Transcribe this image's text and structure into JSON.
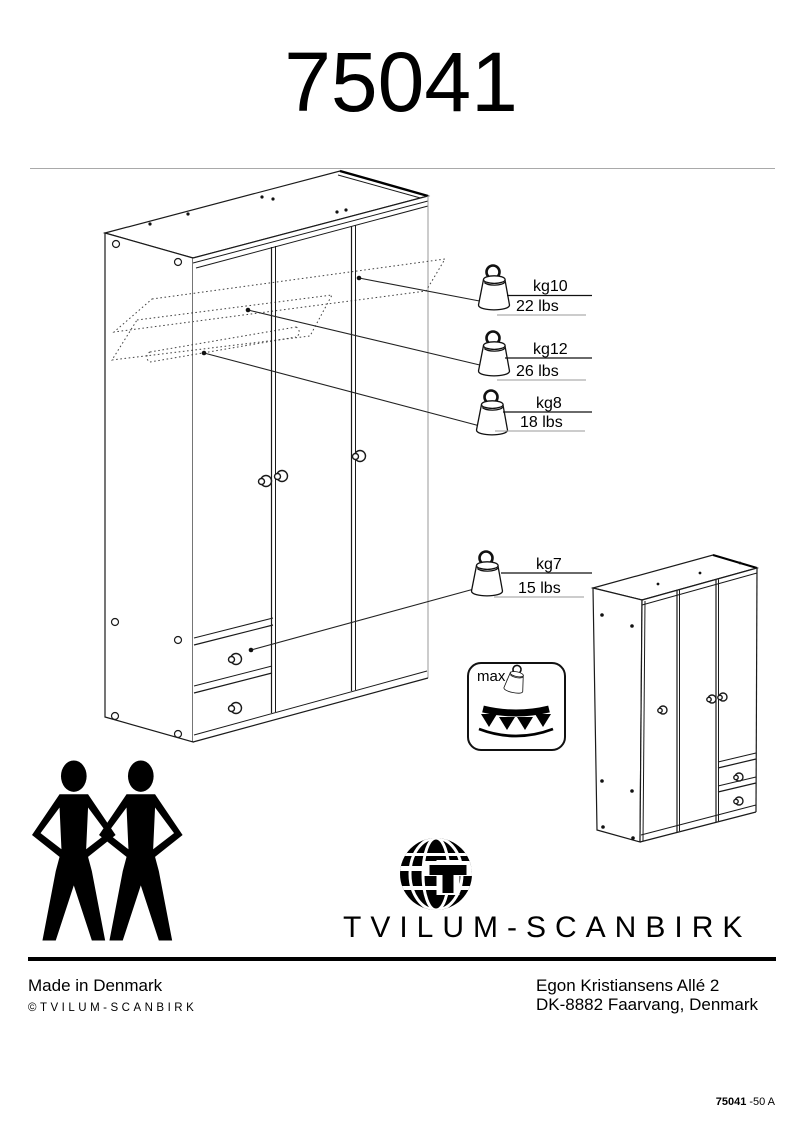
{
  "page": {
    "model_number": "75041",
    "doc_code": "75041",
    "doc_revision": "-50 A"
  },
  "capacity_labels": [
    {
      "kg": "kg10",
      "lbs": "22 lbs"
    },
    {
      "kg": "kg12",
      "lbs": "26 lbs"
    },
    {
      "kg": "kg8",
      "lbs": "18 lbs"
    },
    {
      "kg": "kg7",
      "lbs": "15 lbs"
    }
  ],
  "max_load": {
    "label": "max."
  },
  "assembly": {
    "people_required": 2,
    "people_icon": "two-person-silhouette-icon"
  },
  "brand": {
    "name": "TVILUM-SCANBIRK",
    "logo_icon": "globe-icon"
  },
  "footer": {
    "made_in": "Made in Denmark",
    "copyright": "©TVILUM-SCANBIRK",
    "address_line1": "Egon Kristiansens Allé 2",
    "address_line2": "DK-8882 Faarvang, Denmark"
  },
  "colors": {
    "ink": "#000000",
    "light_line": "#999999"
  },
  "icons": {
    "weight": "weight-kettlebell-icon"
  }
}
